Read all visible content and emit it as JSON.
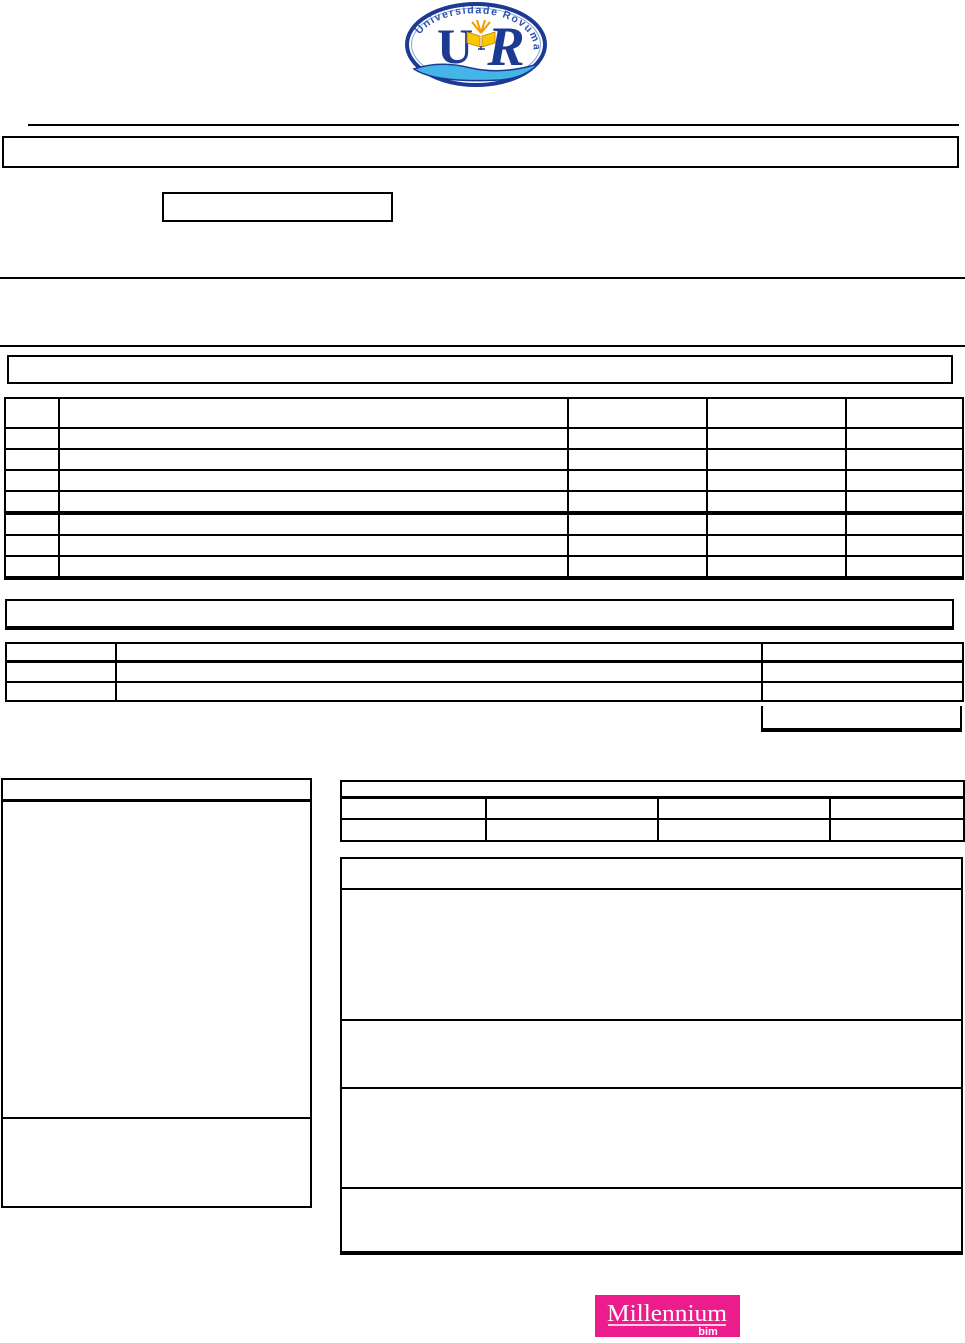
{
  "page": {
    "background": "#ffffff"
  },
  "university_logo": {
    "arc_text": "Universidade Rovuma",
    "monogram_left": "U",
    "monogram_right": "R",
    "ring_color": "#1c3994",
    "arc_text_color": "#2d52ae",
    "book_color": "#f8c800",
    "flame_color": "#f59a00",
    "wave_color": "#45b4e6"
  },
  "footer_logo": {
    "brand": "Millennium",
    "sub_brand": "bim",
    "background_color": "#ec1c8d",
    "text_color": "#ffffff"
  }
}
